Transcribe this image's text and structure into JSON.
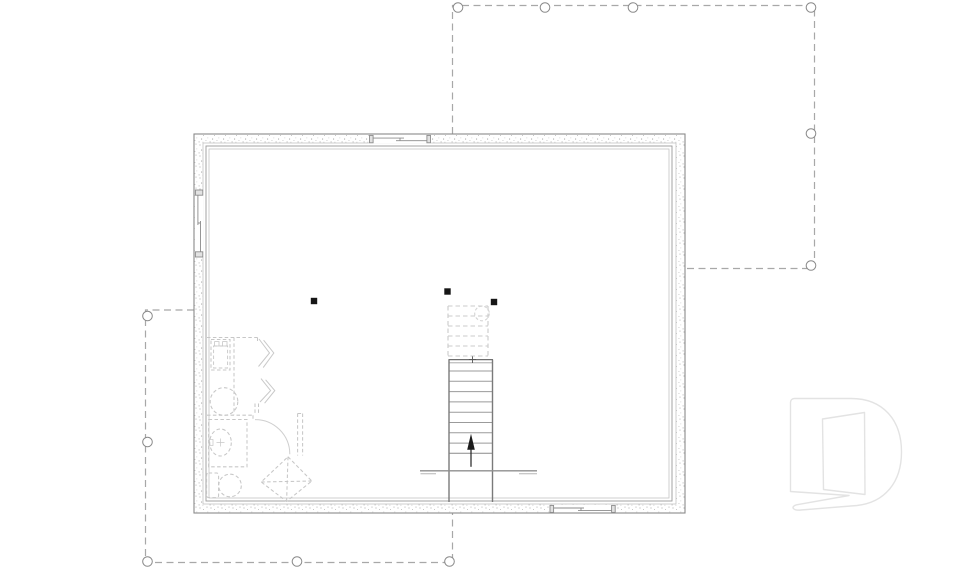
{
  "document": {
    "drawing_kind": "basement-foundation-floor-plan",
    "logo_letter": "D"
  },
  "colors": {
    "background": "#ffffff",
    "wall_line": "#8a8a8a",
    "wall_stipple_dot": "#b0b0b0",
    "inner_face": "#9a9a9a",
    "inner_face_light": "#c4c4c4",
    "deck_dash": "#a8a8a8",
    "pier_stroke": "#8a8a8a",
    "pier_fill": "#ffffff",
    "post_fill": "#161616",
    "stair_solid": "#8c8c8c",
    "stair_dashed": "#cbcbcb",
    "fixture_dash": "#c7c7c7",
    "beam_line": "#8f8f8f",
    "arrow": "#1c1c1c",
    "logo": "#e3e3e3"
  },
  "plan": {
    "structural_posts": 3,
    "upper_right_deck_piers": 6,
    "lower_left_deck_piers": 5,
    "window_openings": 3,
    "stair": {
      "solid_treads": 9,
      "dashed_treads": 6,
      "direction": "up"
    },
    "fixtures": [
      "washer",
      "floor-drain",
      "water-heater",
      "wall-break-symbols",
      "door-swing",
      "vanity-sink",
      "toilet",
      "corner-shower"
    ]
  }
}
